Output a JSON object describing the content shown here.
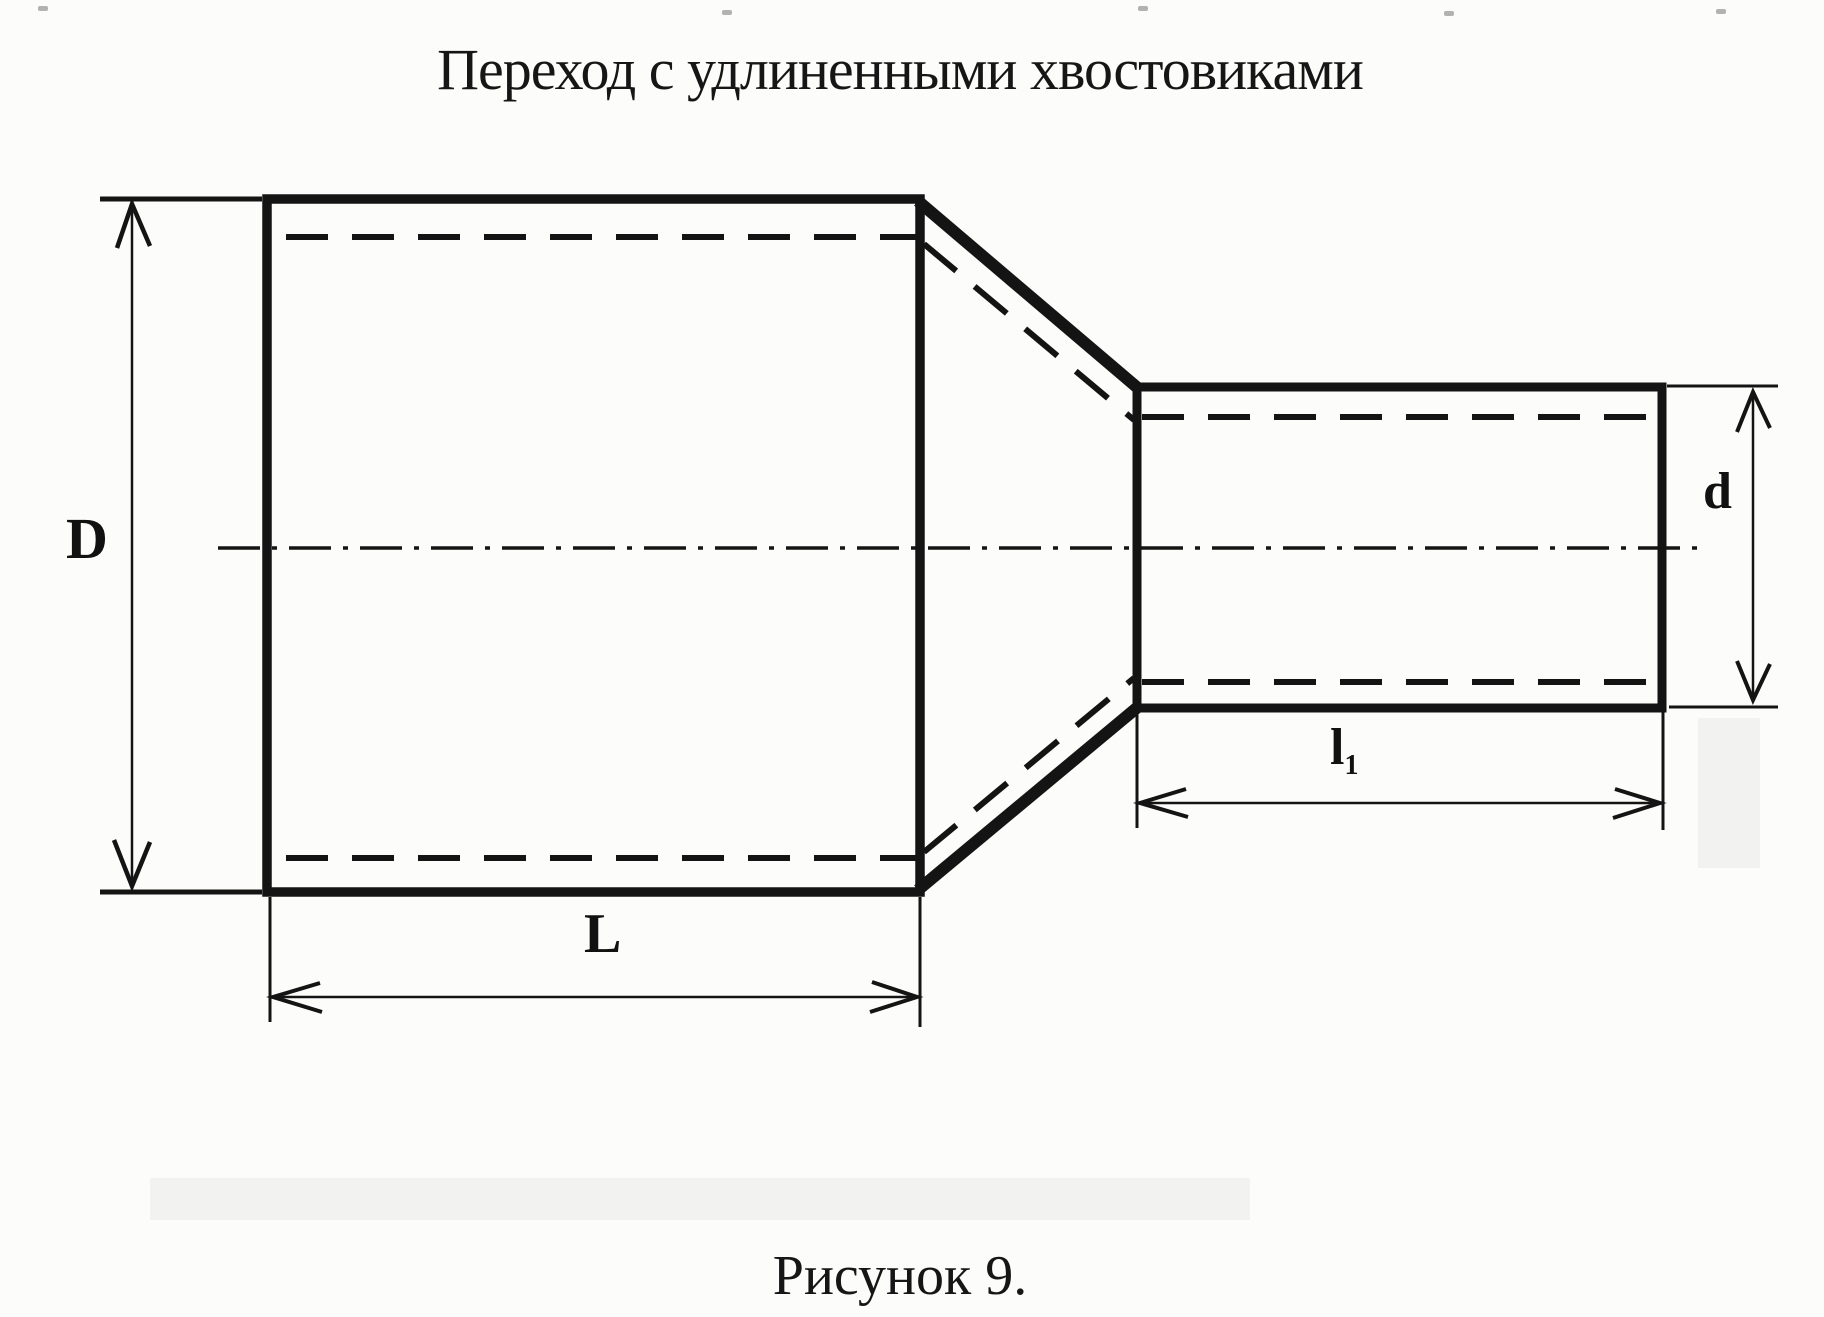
{
  "title": "Переход с удлиненными хвостовиками",
  "caption": "Рисунок 9.",
  "labels": {
    "large_diameter": "D",
    "small_diameter": "d",
    "large_length": "L",
    "small_length_base": "l",
    "small_length_sub": "1"
  },
  "colors": {
    "ink": "#141414",
    "paper": "#fcfcfa"
  },
  "drawing": {
    "kind": "scanned engineering sketch",
    "subject": "pipe reducer (transition) with elongated tailpieces",
    "dimensions_marked": [
      "D",
      "d",
      "L",
      "l1"
    ]
  }
}
